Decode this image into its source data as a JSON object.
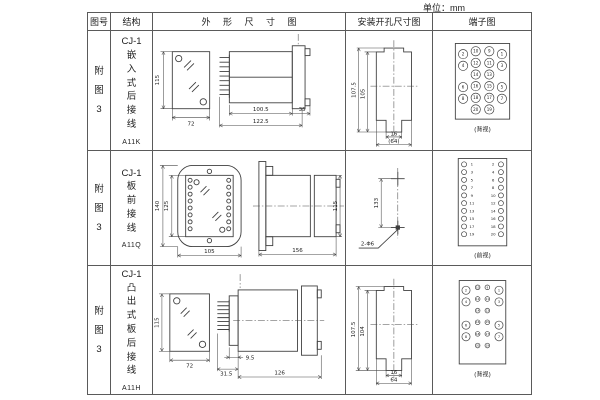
{
  "unit_label": "单位：mm",
  "header": {
    "fig": "图号",
    "structure": "结构",
    "outline": "外 形 尺 寸 图",
    "install": "安装开孔尺寸图",
    "terminal": "端子图"
  },
  "rows": [
    {
      "fig_no": "附\n图\n3",
      "structure": "CJ-1\n嵌\n入\n式\n后\n接\n线",
      "code": "A11K",
      "outline": {
        "front_height": "115",
        "front_width": "72",
        "body_depth": "100.5",
        "total_depth": "122.5",
        "flange_depth": "35"
      },
      "install": {
        "outer_height": "107.5",
        "inner_height": "105",
        "slot_width": "16",
        "overall_width": "(64)"
      },
      "terminal": {
        "caption": "(背视)",
        "pins": [
          {
            "x": 30,
            "y": 17,
            "r": 4.8,
            "n": "2"
          },
          {
            "x": 30,
            "y": 29,
            "r": 4.8,
            "n": "4"
          },
          {
            "x": 30,
            "y": 51,
            "r": 4.8,
            "n": "6"
          },
          {
            "x": 30,
            "y": 63,
            "r": 4.8,
            "n": "8"
          },
          {
            "x": 43,
            "y": 14,
            "r": 4.8,
            "n": "10"
          },
          {
            "x": 43,
            "y": 26,
            "r": 4.8,
            "n": "12"
          },
          {
            "x": 43,
            "y": 38,
            "r": 4.8,
            "n": "14"
          },
          {
            "x": 43,
            "y": 50,
            "r": 4.8,
            "n": "16"
          },
          {
            "x": 43,
            "y": 62,
            "r": 4.8,
            "n": "18"
          },
          {
            "x": 43,
            "y": 74,
            "r": 4.8,
            "n": "20"
          },
          {
            "x": 57,
            "y": 14,
            "r": 4.8,
            "n": "9"
          },
          {
            "x": 57,
            "y": 26,
            "r": 4.8,
            "n": "11"
          },
          {
            "x": 57,
            "y": 38,
            "r": 4.8,
            "n": "13"
          },
          {
            "x": 57,
            "y": 50,
            "r": 4.8,
            "n": "15"
          },
          {
            "x": 57,
            "y": 62,
            "r": 4.8,
            "n": "17"
          },
          {
            "x": 57,
            "y": 74,
            "r": 4.8,
            "n": "19"
          },
          {
            "x": 70,
            "y": 17,
            "r": 4.8,
            "n": "1"
          },
          {
            "x": 70,
            "y": 29,
            "r": 4.8,
            "n": "3"
          },
          {
            "x": 70,
            "y": 51,
            "r": 4.8,
            "n": "5"
          },
          {
            "x": 70,
            "y": 63,
            "r": 4.8,
            "n": "7"
          }
        ]
      }
    },
    {
      "fig_no": "附\n图\n3",
      "structure": "CJ-1\n板\n前\n接\n线",
      "code": "A11Q",
      "outline": {
        "front_height": "140",
        "inner_height": "125",
        "front_width": "105",
        "body_depth": "156",
        "body_height": "115"
      },
      "install": {
        "hole_spacing": "133",
        "hole_label": "2-Φ6"
      },
      "terminal": {
        "caption": "(前视)",
        "pins": [
          {
            "x": 31,
            "y": 11,
            "r": 2.6,
            "n": "1",
            "tx": 39,
            "fs": 4
          },
          {
            "x": 31,
            "y": 19,
            "r": 2.6,
            "n": "3",
            "tx": 39,
            "fs": 4
          },
          {
            "x": 31,
            "y": 27,
            "r": 2.6,
            "n": "5",
            "tx": 39,
            "fs": 4
          },
          {
            "x": 31,
            "y": 35,
            "r": 2.6,
            "n": "7",
            "tx": 39,
            "fs": 4
          },
          {
            "x": 31,
            "y": 43,
            "r": 2.6,
            "n": "9",
            "tx": 39,
            "fs": 4
          },
          {
            "x": 31,
            "y": 51,
            "r": 2.6,
            "n": "11",
            "tx": 39,
            "fs": 4
          },
          {
            "x": 31,
            "y": 59,
            "r": 2.6,
            "n": "13",
            "tx": 39,
            "fs": 4
          },
          {
            "x": 31,
            "y": 67,
            "r": 2.6,
            "n": "15",
            "tx": 39,
            "fs": 4
          },
          {
            "x": 31,
            "y": 75,
            "r": 2.6,
            "n": "17",
            "tx": 39,
            "fs": 4
          },
          {
            "x": 31,
            "y": 83,
            "r": 2.6,
            "n": "19",
            "tx": 39,
            "fs": 4
          },
          {
            "x": 69,
            "y": 11,
            "r": 2.6,
            "n": "2",
            "tx": 61,
            "fs": 4
          },
          {
            "x": 69,
            "y": 19,
            "r": 2.6,
            "n": "4",
            "tx": 61,
            "fs": 4
          },
          {
            "x": 69,
            "y": 27,
            "r": 2.6,
            "n": "6",
            "tx": 61,
            "fs": 4
          },
          {
            "x": 69,
            "y": 35,
            "r": 2.6,
            "n": "8",
            "tx": 61,
            "fs": 4
          },
          {
            "x": 69,
            "y": 43,
            "r": 2.6,
            "n": "10",
            "tx": 61,
            "fs": 4
          },
          {
            "x": 69,
            "y": 51,
            "r": 2.6,
            "n": "12",
            "tx": 61,
            "fs": 4
          },
          {
            "x": 69,
            "y": 59,
            "r": 2.6,
            "n": "14",
            "tx": 61,
            "fs": 4
          },
          {
            "x": 69,
            "y": 67,
            "r": 2.6,
            "n": "16",
            "tx": 61,
            "fs": 4
          },
          {
            "x": 69,
            "y": 75,
            "r": 2.6,
            "n": "18",
            "tx": 61,
            "fs": 4
          },
          {
            "x": 69,
            "y": 83,
            "r": 2.6,
            "n": "20",
            "tx": 61,
            "fs": 4
          }
        ]
      }
    },
    {
      "fig_no": "附\n图\n3",
      "structure": "CJ-1\n凸\n出\n式\n板\n后\n接\n线",
      "code": "A11H",
      "outline": {
        "front_height": "115",
        "front_width": "72",
        "pin_depth": "31.5",
        "base_depth": "9.5",
        "body_depth": "126"
      },
      "install": {
        "outer_height": "107.5",
        "inner_height": "104",
        "slot_width": "16",
        "overall_width": "64"
      },
      "terminal": {
        "caption": "(背视)",
        "pins": [
          {
            "x": 33,
            "y": 18,
            "r": 4.2,
            "n": "2",
            "fs": 3.6
          },
          {
            "x": 33,
            "y": 30,
            "r": 4.2,
            "n": "4",
            "fs": 3.6
          },
          {
            "x": 33,
            "y": 54,
            "r": 4.2,
            "n": "6",
            "fs": 3.6
          },
          {
            "x": 33,
            "y": 66,
            "r": 4.2,
            "n": "8",
            "fs": 3.6
          },
          {
            "x": 45,
            "y": 15,
            "r": 2.4,
            "n": "10",
            "fs": 2.8
          },
          {
            "x": 45,
            "y": 27,
            "r": 2.4,
            "n": "12",
            "fs": 2.8
          },
          {
            "x": 45,
            "y": 39,
            "r": 2.4,
            "n": "14",
            "fs": 2.8
          },
          {
            "x": 45,
            "y": 51,
            "r": 2.4,
            "n": "16",
            "fs": 2.8
          },
          {
            "x": 45,
            "y": 63,
            "r": 2.4,
            "n": "18",
            "fs": 2.8
          },
          {
            "x": 45,
            "y": 75,
            "r": 2.4,
            "n": "20",
            "fs": 2.8
          },
          {
            "x": 55,
            "y": 15,
            "r": 2.4,
            "n": "9",
            "fs": 2.8
          },
          {
            "x": 55,
            "y": 27,
            "r": 2.4,
            "n": "11",
            "fs": 2.8
          },
          {
            "x": 55,
            "y": 39,
            "r": 2.4,
            "n": "13",
            "fs": 2.8
          },
          {
            "x": 55,
            "y": 51,
            "r": 2.4,
            "n": "15",
            "fs": 2.8
          },
          {
            "x": 55,
            "y": 63,
            "r": 2.4,
            "n": "17",
            "fs": 2.8
          },
          {
            "x": 55,
            "y": 75,
            "r": 2.4,
            "n": "19",
            "fs": 2.8
          },
          {
            "x": 67,
            "y": 18,
            "r": 4.2,
            "n": "1",
            "fs": 3.6
          },
          {
            "x": 67,
            "y": 30,
            "r": 4.2,
            "n": "3",
            "fs": 3.6
          },
          {
            "x": 67,
            "y": 54,
            "r": 4.2,
            "n": "5",
            "fs": 3.6
          },
          {
            "x": 67,
            "y": 66,
            "r": 4.2,
            "n": "7",
            "fs": 3.6
          }
        ]
      }
    }
  ]
}
